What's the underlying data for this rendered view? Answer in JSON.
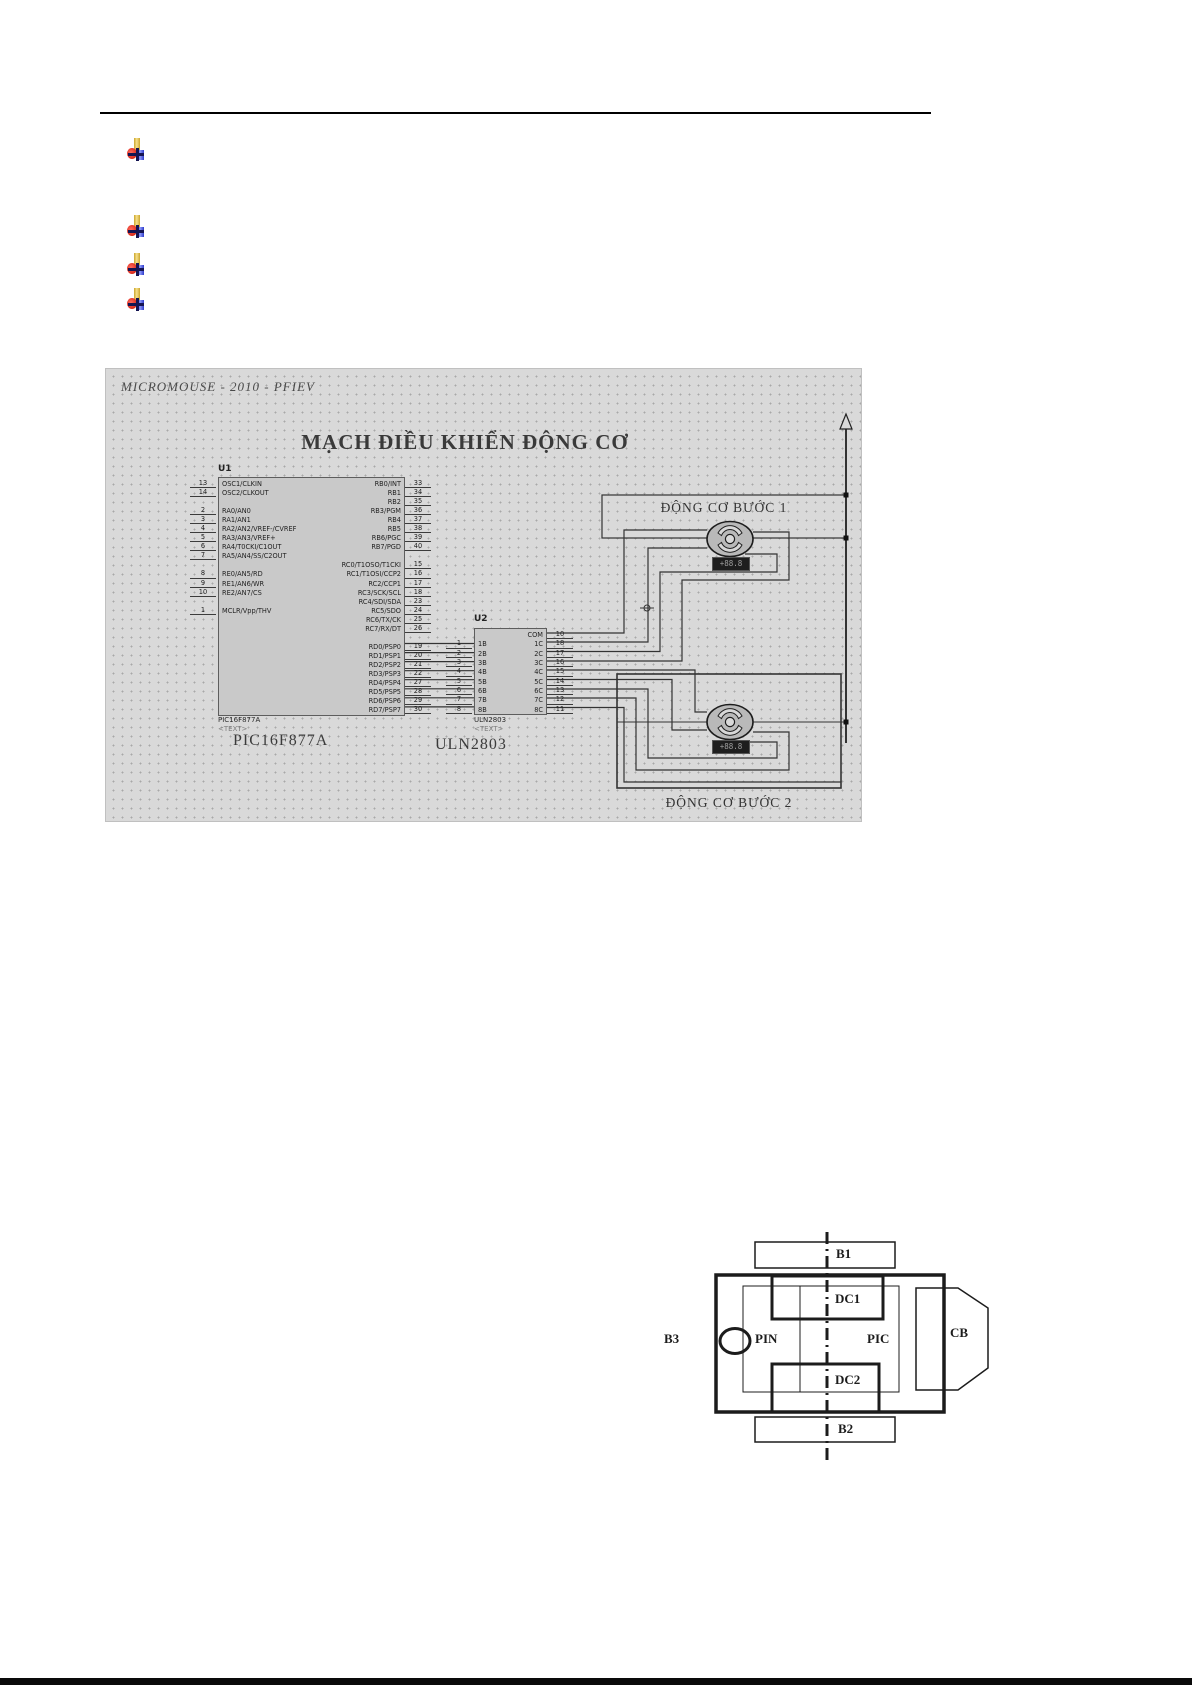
{
  "icons": {
    "bullet": "pin-plus-icon",
    "rail_arrow": "arrow-up-icon",
    "origin_marker": "crosshair-marker-icon"
  },
  "schematic": {
    "header": "MICROMOUSE - 2010 - PFIEV",
    "title": "MẠCH ĐIỀU KHIỂN ĐỘNG CƠ",
    "box1_label": "ĐỘNG CƠ BƯỚC 1",
    "box2_label": "ĐỘNG CƠ BƯỚC 2",
    "rpm": "+88.8",
    "u1": {
      "ref": "U1",
      "part": "PIC16F877A",
      "text_placeholder": "<TEXT>",
      "caption": "PIC16F877A",
      "left_pin_numbers": [
        "13",
        "14",
        "",
        "2",
        "3",
        "4",
        "5",
        "6",
        "7",
        "",
        "8",
        "9",
        "10",
        "",
        "1",
        "",
        "",
        "",
        "",
        "",
        "",
        "",
        "",
        "",
        "",
        ""
      ],
      "left_pin_labels": [
        "OSC1/CLKIN",
        "OSC2/CLKOUT",
        "",
        "RA0/AN0",
        "RA1/AN1",
        "RA2/AN2/VREF-/CVREF",
        "RA3/AN3/VREF+",
        "RA4/T0CKI/C1OUT",
        "RA5/AN4/SS/C2OUT",
        "",
        "RE0/AN5/RD",
        "RE1/AN6/WR",
        "RE2/AN7/CS",
        "",
        "MCLR/Vpp/THV",
        "",
        "",
        "",
        "",
        "",
        "",
        "",
        "",
        "",
        "",
        ""
      ],
      "right_pin_labels": [
        "RB0/INT",
        "RB1",
        "RB2",
        "RB3/PGM",
        "RB4",
        "RB5",
        "RB6/PGC",
        "RB7/PGD",
        "",
        "RC0/T1OSO/T1CKI",
        "RC1/T1OSI/CCP2",
        "RC2/CCP1",
        "RC3/SCK/SCL",
        "RC4/SDI/SDA",
        "RC5/SDO",
        "RC6/TX/CK",
        "RC7/RX/DT",
        "",
        "RD0/PSP0",
        "RD1/PSP1",
        "RD2/PSP2",
        "RD3/PSP3",
        "RD4/PSP4",
        "RD5/PSP5",
        "RD6/PSP6",
        "RD7/PSP7"
      ],
      "right_pin_numbers": [
        "33",
        "34",
        "35",
        "36",
        "37",
        "38",
        "39",
        "40",
        "",
        "15",
        "16",
        "17",
        "18",
        "23",
        "24",
        "25",
        "26",
        "",
        "19",
        "20",
        "21",
        "22",
        "27",
        "28",
        "29",
        "30"
      ]
    },
    "u2": {
      "ref": "U2",
      "part": "ULN2803",
      "text_placeholder": "<TEXT>",
      "caption": "ULN2803",
      "left_pin_numbers": [
        "",
        "1",
        "2",
        "3",
        "4",
        "5",
        "6",
        "7",
        "8"
      ],
      "left_pin_labels": [
        "",
        "1B",
        "2B",
        "3B",
        "4B",
        "5B",
        "6B",
        "7B",
        "8B"
      ],
      "right_pin_labels": [
        "COM",
        "1C",
        "2C",
        "3C",
        "4C",
        "5C",
        "6C",
        "7C",
        "8C"
      ],
      "right_pin_numbers": [
        "10",
        "18",
        "17",
        "16",
        "15",
        "14",
        "13",
        "12",
        "11"
      ]
    }
  },
  "block_diagram": {
    "b1": "B1",
    "b2": "B2",
    "b3": "B3",
    "dc1": "DC1",
    "dc2": "DC2",
    "pin": "PIN",
    "pic": "PIC",
    "cb": "CB"
  }
}
